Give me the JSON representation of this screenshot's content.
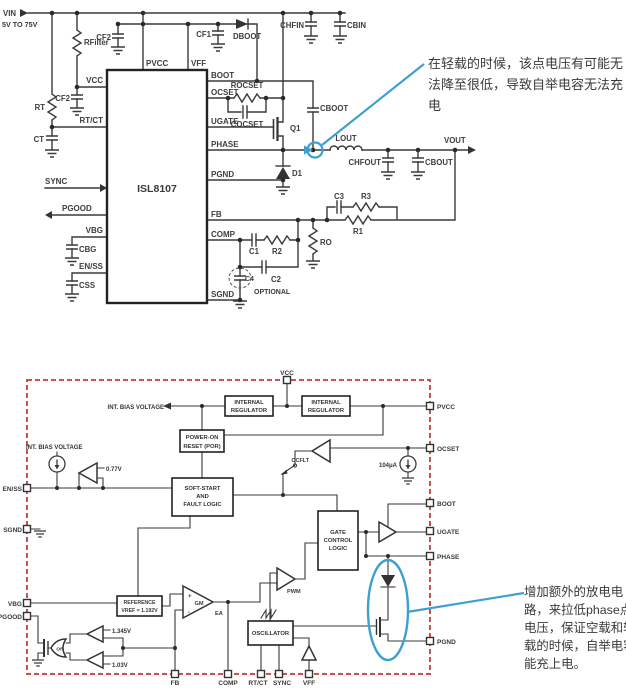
{
  "annotations": {
    "accent_color": "#3e9fd2",
    "top_note": [
      "在轻载的时候，该点电压有可能无",
      "法降至很低，导致自举电容无法充",
      "电"
    ],
    "bottom_note": [
      "增加额外的放电电",
      "路，来拉低phase点",
      "电压，保证空载和轻",
      "载的时候，自举电容",
      "能充上电。"
    ]
  },
  "top": {
    "chip_name": "ISL8107",
    "vin": "VIN",
    "vin_range": "5V TO 75V",
    "pins_top": [
      "PVCC",
      "VFF"
    ],
    "pins_left": [
      "VCC",
      "RT/CT",
      "SYNC",
      "PGOOD",
      "VBG",
      "EN/SS"
    ],
    "pins_right": [
      "BOOT",
      "OCSET",
      "UGATE",
      "PHASE",
      "PGND",
      "FB",
      "COMP",
      "SGND"
    ],
    "parts": {
      "rfilter": "RFilter",
      "cf2_top": "CF2",
      "cf2_vcc": "CF2",
      "cf1": "CF1",
      "dboot": "DBOOT",
      "chfin": "CHFIN",
      "cbin": "CBIN",
      "rt": "RT",
      "ct": "CT",
      "rocset": "ROCSET",
      "cocset": "COCSET",
      "q1": "Q1",
      "d1": "D1",
      "cboot": "CBOOT",
      "lout": "LOUT",
      "vout": "VOUT",
      "chfout": "CHFOUT",
      "cbout": "CBOUT",
      "c3": "C3",
      "r3": "R3",
      "r1": "R1",
      "ro": "RO",
      "c1": "C1",
      "r2": "R2",
      "c2": "C2",
      "c4": "C4",
      "optional": "OPTIONAL",
      "cbg": "CBG",
      "css": "CSS"
    }
  },
  "block": {
    "border_color": "#c43b3b",
    "pins": {
      "vcc": "VCC",
      "pvcc": "PVCC",
      "ocset": "OCSET",
      "boot": "BOOT",
      "ugate": "UGATE",
      "phase": "PHASE",
      "pgnd": "PGND",
      "enss": "EN/SS",
      "sgnd": "SGND",
      "vbg": "VBG",
      "pgood": "PGOOD",
      "fb": "FB",
      "comp": "COMP",
      "rtct": "RT/CT",
      "sync": "SYNC",
      "vff": "VFF"
    },
    "int_reg": [
      "INTERNAL",
      "REGULATOR"
    ],
    "por": [
      "POWER-ON",
      "RESET (POR)"
    ],
    "soft_start": [
      "SOFT-START",
      "AND",
      "FAULT LOGIC"
    ],
    "gcl": [
      "GATE",
      "CONTROL",
      "LOGIC"
    ],
    "osc": "OSCILLATOR",
    "ref": [
      "REFERENCE",
      "VREF = 1.192V"
    ],
    "int_bias_left": "INT. BIAS VOLTAGE",
    "int_bias_top": "INT. BIAS VOLTAGE",
    "v_enable": "0.77V",
    "i_ocset": "104μA",
    "ocflt": "OCFLT",
    "pwm": "PWM",
    "gm": "GM",
    "ea": "EA",
    "or_gate": "OR",
    "v_upper": "1.345V",
    "v_lower": "1.03V",
    "plus": "+",
    "minus": "-"
  }
}
